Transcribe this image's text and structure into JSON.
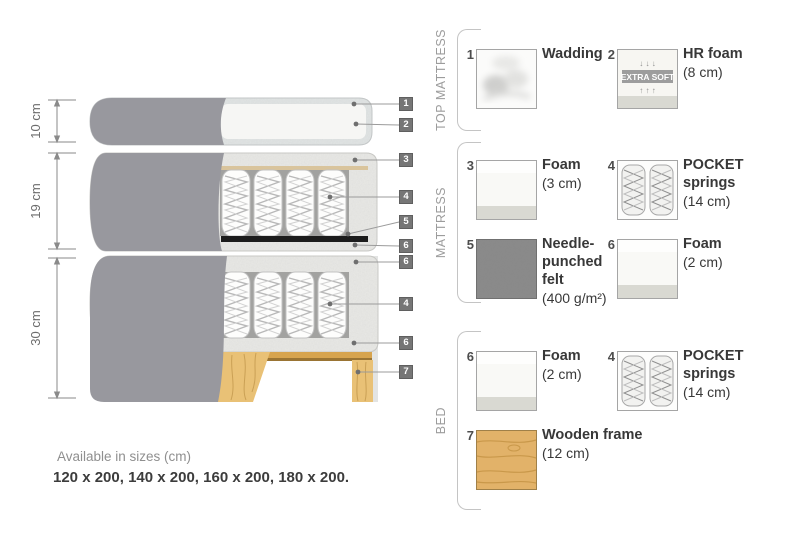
{
  "note": {
    "line1": "Available in sizes (cm)",
    "line2": "120 x 200, 140 x 200, 160 x 200, 180 x 200."
  },
  "diagram": {
    "dimension_labels": [
      "10 cm",
      "19 cm",
      "30 cm"
    ],
    "markers": [
      "1",
      "2",
      "3",
      "4",
      "5",
      "6",
      "6",
      "4",
      "6",
      "7"
    ]
  },
  "legend": {
    "sections": [
      {
        "title": "TOP MATTRESS"
      },
      {
        "title": "MATTRESS"
      },
      {
        "title": "BED"
      }
    ],
    "items": [
      {
        "num": "1",
        "name": "Wadding",
        "detail": ""
      },
      {
        "num": "2",
        "name": "HR foam",
        "detail": "(8 cm)",
        "badge": "EXTRA SOFT"
      },
      {
        "num": "3",
        "name": "Foam",
        "detail": "(3 cm)"
      },
      {
        "num": "4",
        "name": "POCKET springs",
        "detail": "(14 cm)"
      },
      {
        "num": "5",
        "name": "Needle-punched felt",
        "detail": "(400 g/m²)"
      },
      {
        "num": "6",
        "name": "Foam",
        "detail": "(2 cm)"
      },
      {
        "num": "6",
        "name": "Foam",
        "detail": "(2 cm)"
      },
      {
        "num": "4",
        "name": "POCKET springs",
        "detail": "(14 cm)"
      },
      {
        "num": "7",
        "name": "Wooden frame",
        "detail": "(12 cm)"
      }
    ]
  },
  "icons": {
    "soft_arrows_down": "↓ ↓ ↓",
    "soft_arrows_up": "↑ ↑ ↑"
  },
  "colors": {
    "cover_gray": "#98989e",
    "speckle_base": "#e9e9e6",
    "wood": "#e9c176",
    "wood_rail": "#d7a44e",
    "felt": "#1c1c1c",
    "marker_bg": "#767676",
    "text_dark": "#383838",
    "text_gray": "#9c9c9c"
  }
}
